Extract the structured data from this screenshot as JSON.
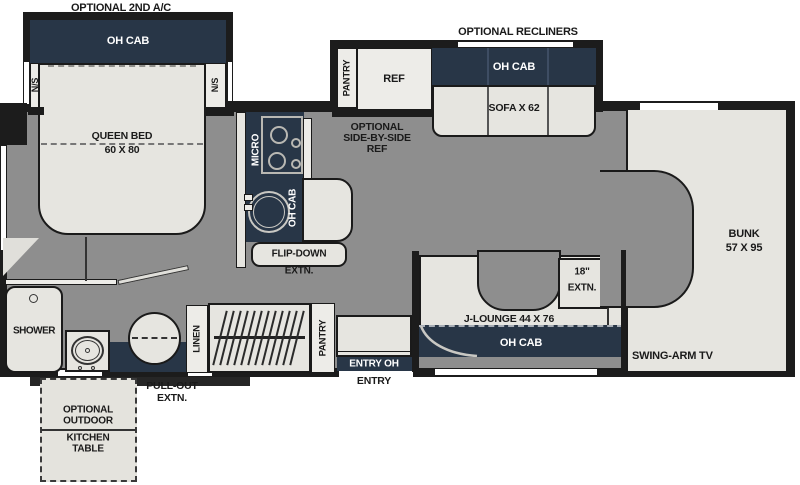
{
  "colors": {
    "wall": "#1c1c1c",
    "floor_gray": "#8e8e8e",
    "cabinet_navy": "#283647",
    "fixture_light": "#e6e5e0",
    "window_white": "#ffffff",
    "text_dark": "#1a1a1a",
    "text_light": "#ffffff"
  },
  "bedroom": {
    "optional_ac": "OPTIONAL 2ND A/C",
    "oh_cab": "OH CAB",
    "ns_left": "N/S",
    "ns_right": "N/S",
    "queen_bed": "QUEEN BED",
    "bed_size": "60 X 80"
  },
  "kitchen": {
    "micro": "MICRO",
    "oh_cab": "OH CAB",
    "flip_down": "FLIP-DOWN",
    "flip_down_extn": "EXTN."
  },
  "galley_slide": {
    "optional_recliners": "OPTIONAL RECLINERS",
    "pantry": "PANTRY",
    "ref": "REF",
    "oh_cab": "OH CAB",
    "sofa": "SOFA X 62",
    "optional_ref_1": "OPTIONAL",
    "optional_ref_2": "SIDE-BY-SIDE",
    "optional_ref_3": "REF"
  },
  "lounge": {
    "extn_inches": "18\"",
    "extn": "EXTN.",
    "label": "J-LOUNGE 44 X 76",
    "oh_cab": "OH CAB"
  },
  "bunk": {
    "name": "BUNK",
    "size": "57 X 95",
    "tv": "SWING-ARM TV"
  },
  "bath": {
    "shower": "SHOWER",
    "linen": "LINEN",
    "pantry": "PANTRY"
  },
  "entry": {
    "entry_oh": "ENTRY OH",
    "entry": "ENTRY"
  },
  "exterior": {
    "pull_out": "PULL-OUT",
    "pull_out_extn": "EXTN.",
    "outdoor_1": "OPTIONAL",
    "outdoor_2": "OUTDOOR",
    "outdoor_3": "KITCHEN",
    "outdoor_4": "TABLE"
  }
}
